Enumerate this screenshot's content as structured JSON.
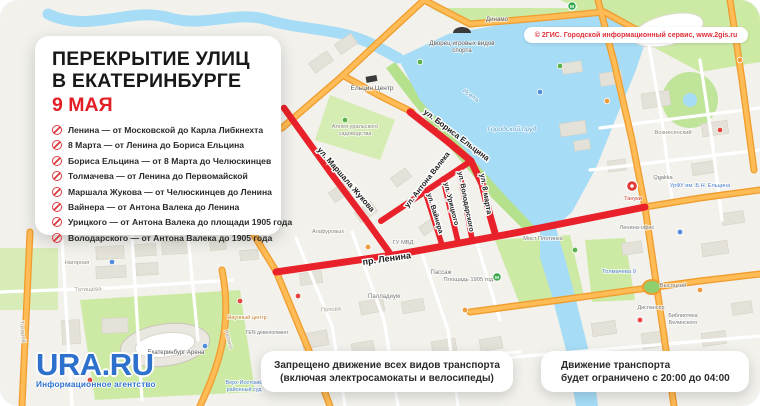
{
  "panel": {
    "title_line1": "ПЕРЕКРЫТИЕ УЛИЦ",
    "title_line2": "В ЕКАТЕРИНБУРГЕ",
    "date": "9 МАЯ",
    "items": [
      "Ленина — от Московской до Карла Либкнехта",
      "8 Марта — от Ленина до Бориса Ельцина",
      "Бориса Ельцина — от 8 Марта до Челюскинцев",
      "Толмачева — от Ленина до Первомайской",
      "Маршала Жукова — от Челюскинцев до Ленина",
      "Вайнера — от Антона Валека до Ленина",
      "Урицкого — от Антона Валека до площади 1905 года",
      "Володарского — от Антона Валека до 1905 года"
    ]
  },
  "attribution": "© 2ГИС. Городской информационный сервис, www.2gis.ru",
  "notes": {
    "ban_line1": "Запрещено движение всех видов транспорта",
    "ban_line2": "(включая электросамокаты и велосипеды)",
    "limit_line1": "Движение транспорта",
    "limit_line2": "будет ограничено с 20:00 до 04:00"
  },
  "logo": {
    "name": "URA.RU",
    "tagline": "Информационное агентство"
  },
  "map": {
    "colors": {
      "closure": "#e8212a",
      "halo": "#ffffff",
      "water_label": "#5c9fc7"
    },
    "closures": [
      {
        "name": "prospekt-lenina",
        "w": 7,
        "points": [
          [
            276,
            272
          ],
          [
            400,
            254
          ],
          [
            520,
            232
          ],
          [
            645,
            207
          ]
        ],
        "label": "пр. Ленина",
        "lx": 363,
        "ly": 265,
        "rot": -8,
        "ls": 9
      },
      {
        "name": "marshala-zhukova",
        "w": 6.5,
        "points": [
          [
            284,
            108
          ],
          [
            330,
            172
          ],
          [
            366,
            220
          ],
          [
            389,
            252
          ]
        ],
        "label": "ул. Маршала Жукова",
        "lx": 317,
        "ly": 150,
        "rot": 49,
        "ls": 8
      },
      {
        "name": "borisa-yeltsina",
        "w": 7,
        "points": [
          [
            410,
            112
          ],
          [
            447,
            141
          ],
          [
            471,
            161
          ],
          [
            482,
            184
          ],
          [
            489,
            212
          ],
          [
            495,
            233
          ]
        ],
        "label": "ул. Бориса Ельцина",
        "lx": 423,
        "ly": 113,
        "rot": 37,
        "ls": 8
      },
      {
        "name": "antona-valeka",
        "w": 6,
        "points": [
          [
            381,
            221
          ],
          [
            468,
            163
          ]
        ],
        "label": "ул. Антона Валека",
        "lx": 408,
        "ly": 208,
        "rot": -52,
        "ls": 7.5
      },
      {
        "name": "vaynera",
        "w": 5.5,
        "points": [
          [
            425,
            191
          ],
          [
            442,
            245
          ]
        ],
        "label": "ул. Вайнера",
        "lx": 427,
        "ly": 194,
        "rot": 73,
        "ls": 7
      },
      {
        "name": "uritskogo",
        "w": 5.5,
        "points": [
          [
            443,
            179
          ],
          [
            458,
            242
          ]
        ],
        "label": "ул. Урицкого",
        "lx": 444,
        "ly": 183,
        "rot": 76,
        "ls": 7
      },
      {
        "name": "volodarskogo",
        "w": 5.5,
        "points": [
          [
            459,
            169
          ],
          [
            472,
            239
          ]
        ],
        "label": "ул. Володарского",
        "lx": 458,
        "ly": 172,
        "rot": 79,
        "ls": 7
      },
      {
        "name": "vosmogo-marta",
        "w": 0,
        "points": [],
        "label": "ул. 8 марта",
        "lx": 480,
        "ly": 174,
        "rot": 80,
        "ls": 7.5
      }
    ],
    "poi_labels": [
      {
        "t": "Ельцин Центр",
        "x": 372,
        "y": 90,
        "c": "#555555",
        "s": 6.5
      },
      {
        "t": "Дворец игровых видов",
        "x": 462,
        "y": 45,
        "c": "#555555",
        "s": 6.2
      },
      {
        "t": "спорта",
        "x": 462,
        "y": 52,
        "c": "#555555",
        "s": 6.2
      },
      {
        "t": "Динамо",
        "x": 497,
        "y": 21,
        "c": "#555555",
        "s": 6.2
      },
      {
        "t": "Городской пруд",
        "x": 512,
        "y": 131,
        "c": "#5c9fc7",
        "s": 6.8,
        "i": 1
      },
      {
        "t": "Исеть",
        "x": 470,
        "y": 97,
        "c": "#5c9fc7",
        "s": 6.2,
        "i": 1,
        "r": 36
      },
      {
        "t": "Аллея уральского",
        "x": 355,
        "y": 128,
        "c": "#8a8778",
        "s": 5.6
      },
      {
        "t": "садоводства",
        "x": 355,
        "y": 135,
        "c": "#8a8778",
        "s": 5.6
      },
      {
        "t": "ГУ МВД",
        "x": 403,
        "y": 244,
        "c": "#777777",
        "s": 5.8
      },
      {
        "t": "Пассаж",
        "x": 441,
        "y": 274,
        "c": "#777777",
        "s": 6
      },
      {
        "t": "Палладиум",
        "x": 384,
        "y": 298,
        "c": "#777777",
        "s": 6
      },
      {
        "t": "Площадь 1905 года",
        "x": 470,
        "y": 281,
        "c": "#777777",
        "s": 5.8
      },
      {
        "t": "Попова",
        "x": 331,
        "y": 311,
        "c": "#a09c90",
        "s": 5.8,
        "r": -4
      },
      {
        "t": "Агафуровых",
        "x": 328,
        "y": 233,
        "c": "#8a8778",
        "s": 5.6
      },
      {
        "t": "Мост Плотинка",
        "x": 543,
        "y": 240,
        "c": "#777777",
        "s": 5.6
      },
      {
        "t": "Толмачева 9",
        "x": 619,
        "y": 273,
        "c": "#4a7fd1",
        "s": 5.8
      },
      {
        "t": "Ленина-офис",
        "x": 637,
        "y": 229,
        "c": "#777777",
        "s": 5.6
      },
      {
        "t": "Высоцкий",
        "x": 673,
        "y": 287,
        "c": "#777777",
        "s": 5.8
      },
      {
        "t": "Библиотека",
        "x": 683,
        "y": 317,
        "c": "#777777",
        "s": 5.4
      },
      {
        "t": "Белинского",
        "x": 683,
        "y": 324,
        "c": "#777777",
        "s": 5.4
      },
      {
        "t": "Диспансер",
        "x": 651,
        "y": 309,
        "c": "#777777",
        "s": 5.4
      },
      {
        "t": "Вознесенский",
        "x": 673,
        "y": 134,
        "c": "#8a8778",
        "s": 5.8
      },
      {
        "t": "Quakka",
        "x": 663,
        "y": 179,
        "c": "#777777",
        "s": 5.6
      },
      {
        "t": "УрФУ им. Б.Н. Ельцина",
        "x": 700,
        "y": 187,
        "c": "#4a7fd1",
        "s": 5.6
      },
      {
        "t": "Тануки",
        "x": 633,
        "y": 200,
        "c": "#c0392f",
        "s": 5.6
      },
      {
        "t": "Татищева",
        "x": 88,
        "y": 291,
        "c": "#a09c90",
        "s": 6,
        "r": -2
      },
      {
        "t": "Нагорная",
        "x": 77,
        "y": 264,
        "c": "#8a8778",
        "s": 5.6
      },
      {
        "t": "Токарей",
        "x": 21,
        "y": 332,
        "c": "#a09c90",
        "s": 5.8,
        "r": 84
      },
      {
        "t": "Репина",
        "x": 227,
        "y": 340,
        "c": "#a09c90",
        "s": 5.8,
        "r": 72
      },
      {
        "t": "Екатеринбург Арена",
        "x": 176,
        "y": 354,
        "c": "#555555",
        "s": 6
      },
      {
        "t": "Верх-Исетский",
        "x": 244,
        "y": 384,
        "c": "#4a7fd1",
        "s": 5.4
      },
      {
        "t": "районный суд",
        "x": 244,
        "y": 391,
        "c": "#4a7fd1",
        "s": 5.4
      },
      {
        "t": "Научный центр",
        "x": 247,
        "y": 319,
        "c": "#c77f2e",
        "s": 5.6
      },
      {
        "t": "TEN девелопмент",
        "x": 267,
        "y": 334,
        "c": "#777777",
        "s": 5.2
      }
    ],
    "buildings": [
      [
        96,
        246,
        28,
        13,
        -3
      ],
      [
        132,
        244,
        24,
        12,
        -3
      ],
      [
        162,
        241,
        26,
        13,
        -3
      ],
      [
        96,
        266,
        30,
        12,
        -3
      ],
      [
        136,
        263,
        22,
        12,
        -3
      ],
      [
        62,
        320,
        18,
        24,
        -3
      ],
      [
        102,
        318,
        26,
        15,
        -2
      ],
      [
        210,
        240,
        16,
        10,
        -5
      ],
      [
        240,
        250,
        18,
        10,
        -5
      ],
      [
        300,
        272,
        22,
        12,
        -8
      ],
      [
        360,
        300,
        24,
        13,
        -10
      ],
      [
        402,
        300,
        22,
        12,
        -10
      ],
      [
        302,
        332,
        26,
        15,
        -10
      ],
      [
        352,
        342,
        22,
        13,
        -10
      ],
      [
        432,
        340,
        24,
        12,
        -10
      ],
      [
        480,
        338,
        22,
        12,
        -10
      ],
      [
        330,
        186,
        20,
        12,
        -35
      ],
      [
        356,
        206,
        20,
        12,
        -35
      ],
      [
        392,
        172,
        18,
        11,
        -35
      ],
      [
        420,
        222,
        16,
        10,
        -35
      ],
      [
        310,
        56,
        22,
        12,
        -35
      ],
      [
        336,
        38,
        20,
        12,
        -35
      ],
      [
        560,
        122,
        26,
        13,
        -8
      ],
      [
        600,
        72,
        22,
        13,
        -8
      ],
      [
        642,
        92,
        28,
        15,
        -8
      ],
      [
        702,
        122,
        26,
        13,
        -8
      ],
      [
        562,
        62,
        20,
        11,
        -8
      ],
      [
        692,
        162,
        24,
        12,
        -8
      ],
      [
        722,
        212,
        22,
        12,
        -8
      ],
      [
        702,
        242,
        26,
        13,
        -8
      ],
      [
        622,
        242,
        20,
        12,
        -8
      ],
      [
        592,
        322,
        24,
        13,
        -8
      ],
      [
        642,
        332,
        26,
        15,
        -8
      ],
      [
        702,
        332,
        24,
        13,
        -8
      ],
      [
        732,
        302,
        20,
        12,
        -8
      ],
      [
        608,
        160,
        18,
        11,
        -8
      ],
      [
        574,
        140,
        16,
        10,
        -8
      ]
    ],
    "dots": [
      [
        298,
        296,
        "#e4453f"
      ],
      [
        368,
        247,
        "#f09c3c"
      ],
      [
        436,
        130,
        "#59b24c"
      ],
      [
        560,
        66,
        "#59b24c"
      ],
      [
        540,
        92,
        "#4f8ed8"
      ],
      [
        607,
        101,
        "#f09c3c"
      ],
      [
        680,
        232,
        "#4f8ed8"
      ],
      [
        720,
        130,
        "#e4453f"
      ],
      [
        640,
        320,
        "#e4453f"
      ],
      [
        700,
        290,
        "#f09c3c"
      ],
      [
        240,
        301,
        "#e4453f"
      ],
      [
        112,
        262,
        "#4f8ed8"
      ],
      [
        205,
        346,
        "#4f8ed8"
      ],
      [
        420,
        62,
        "#59b24c"
      ],
      [
        575,
        250,
        "#59b24c"
      ],
      [
        345,
        120,
        "#59b24c"
      ],
      [
        90,
        380,
        "#e4453f"
      ],
      [
        740,
        60,
        "#f09c3c"
      ],
      [
        465,
        310,
        "#f09c3c"
      ],
      [
        660,
        178,
        "#8e8e8e"
      ]
    ],
    "metro": [
      [
        497,
        277
      ],
      [
        572,
        6
      ]
    ],
    "marker_tanuki": {
      "x": 632,
      "y": 186
    }
  }
}
